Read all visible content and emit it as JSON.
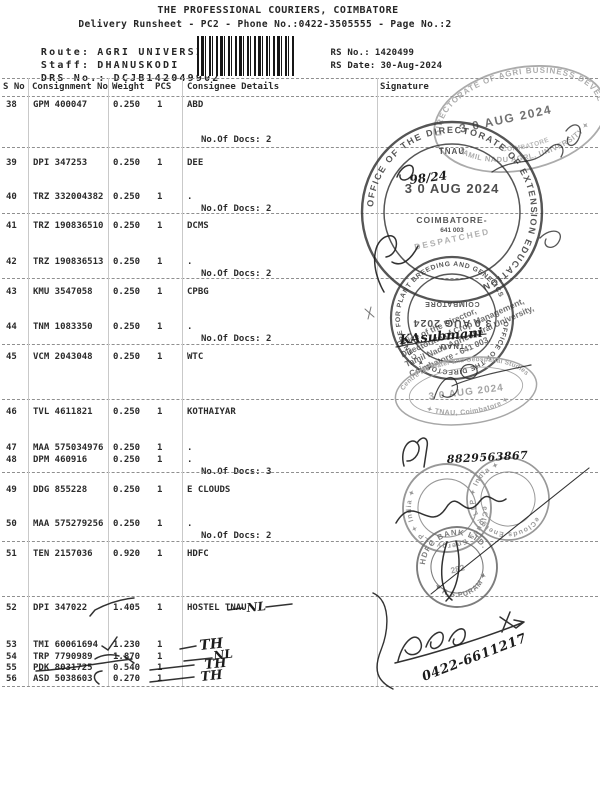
{
  "header": {
    "title": "THE PROFESSIONAL COURIERS, COIMBATORE",
    "subtitle": "Delivery Runsheet - PC2 - Phone No.:0422-3505555 - Page No.:2",
    "route_label": "Route:",
    "route_value": "AGRI UNIVERSITY -1",
    "staff_label": "Staff:",
    "staff_value": "DHANUSKODI",
    "drs_label": "DRS No.:",
    "drs_value": "DCJB142049902",
    "rs_no_label": "RS No.:",
    "rs_no_value": "1420499",
    "rs_date_label": "RS Date:",
    "rs_date_value": "30-Aug-2024"
  },
  "table": {
    "headers": {
      "sno": "S No",
      "cn": "Consignment No",
      "wt": "Weight",
      "pcs": "PCS",
      "consignee": "Consignee Details",
      "signature": "Signature"
    },
    "rows": [
      {
        "sno": "38",
        "cn": "GPM 400047",
        "wt": "0.250",
        "pcs": "1",
        "consignee": "ABD",
        "docs": "No.Of Docs: 2"
      },
      {
        "sno": "39",
        "cn": "DPI 347253",
        "wt": "0.250",
        "pcs": "1",
        "consignee": "DEE",
        "docs": ""
      },
      {
        "sno": "40",
        "cn": "TRZ 332004382",
        "wt": "0.250",
        "pcs": "1",
        "consignee": ".",
        "docs": "No.Of Docs: 2"
      },
      {
        "sno": "41",
        "cn": "TRZ 190836510",
        "wt": "0.250",
        "pcs": "1",
        "consignee": "DCMS",
        "docs": ""
      },
      {
        "sno": "42",
        "cn": "TRZ 190836513",
        "wt": "0.250",
        "pcs": "1",
        "consignee": ".",
        "docs": "No.Of Docs: 2"
      },
      {
        "sno": "43",
        "cn": "KMU 3547058",
        "wt": "0.250",
        "pcs": "1",
        "consignee": "CPBG",
        "docs": ""
      },
      {
        "sno": "44",
        "cn": "TNM 1083350",
        "wt": "0.250",
        "pcs": "1",
        "consignee": ".",
        "docs": "No.Of Docs: 2"
      },
      {
        "sno": "45",
        "cn": "VCM 2043048",
        "wt": "0.250",
        "pcs": "1",
        "consignee": "WTC",
        "docs": ""
      },
      {
        "sno": "46",
        "cn": "TVL 4611821",
        "wt": "0.250",
        "pcs": "1",
        "consignee": "KOTHAIYAR",
        "docs": ""
      },
      {
        "sno": "47",
        "cn": "MAA 575034976",
        "wt": "0.250",
        "pcs": "1",
        "consignee": ".",
        "docs": ""
      },
      {
        "sno": "48",
        "cn": "DPM 460916",
        "wt": "0.250",
        "pcs": "1",
        "consignee": ".",
        "docs": "No.Of Docs: 3"
      },
      {
        "sno": "49",
        "cn": "DDG 855228",
        "wt": "0.250",
        "pcs": "1",
        "consignee": "E CLOUDS",
        "docs": ""
      },
      {
        "sno": "50",
        "cn": "MAA 575279256",
        "wt": "0.250",
        "pcs": "1",
        "consignee": ".",
        "docs": "No.Of Docs: 2"
      },
      {
        "sno": "51",
        "cn": "TEN 2157036",
        "wt": "0.920",
        "pcs": "1",
        "consignee": "HDFC",
        "docs": ""
      },
      {
        "sno": "52",
        "cn": "DPI 347022",
        "wt": "1.405",
        "pcs": "1",
        "consignee": "HOSTEL TNAU",
        "docs": ""
      },
      {
        "sno": "53",
        "cn": "TMI 60061694",
        "wt": "1.230",
        "pcs": "1",
        "consignee": "",
        "docs": ""
      },
      {
        "sno": "54",
        "cn": "TRP 7790989",
        "wt": "1.870",
        "pcs": "1",
        "consignee": "",
        "docs": ""
      },
      {
        "sno": "55",
        "cn": "PDK 8031725",
        "wt": "0.540",
        "pcs": "1",
        "consignee": "",
        "docs": ""
      },
      {
        "sno": "56",
        "cn": "ASD 5038603",
        "wt": "0.270",
        "pcs": "1",
        "consignee": "",
        "docs": ""
      }
    ]
  },
  "stamps": {
    "agri": {
      "arc_top": "DIRECTORATE OF AGRI BUSINESS DEVEL",
      "arc_bottom": "TAMIL NADU AGRL. UNIVERSITY ✦",
      "arc_inner": "COIMBATORE",
      "date": "3 0 AUG 2024"
    },
    "extension": {
      "ring": "OFFICE OF THE DIRECTORATE OF EXTENSION EDUCATION",
      "tnau": "TNAU",
      "date": "3 0 AUG 2024",
      "city": "COIMBATORE-",
      "pin": "641 003",
      "despatched": "DESPATCHED"
    },
    "crop_office": {
      "lines": [
        "Office of the Director,",
        "Directorate of Crop Management,",
        "Tamil Nadu Agricultural University,",
        "Coimbatore - 641 003."
      ]
    },
    "director": {
      "ring": "OFFICE OF THE DIRECTOR ✦ CENTRE FOR PLANT BREEDING AND GENETICS",
      "tnau": "TNAU",
      "date": "3 0 AUG 2024",
      "city": "COIMBATORE"
    },
    "studies": {
      "arc_top": "Centre for Water and Geospatial Studies",
      "date": "3 0 AUG 2024",
      "arc_bottom": "✦ TNAU, Coimbatore ✦"
    },
    "eclouds": {
      "ring": "eClouds Energy LLP ✦ India ✦"
    },
    "hdfc": {
      "arc_top": "HDFC BANK LTD.",
      "arc_bottom": "✦ R.S.PURAM ✦",
      "code": "282"
    }
  },
  "handwriting": {
    "row52_mark": "NL",
    "row53_mark": "TH",
    "row54_mark": "NL",
    "row55_mark": "TH",
    "row56_mark": "TH",
    "extension_note": "98/24",
    "director_sign": "KAsubmani",
    "mobile": "8829563867",
    "phone": "0422-6611217"
  },
  "colors": {
    "paper": "#ffffff",
    "print_ink": "#262626",
    "stamp_ink_dark": "#383838",
    "stamp_ink_light": "#979797",
    "pen_ink": "#1c1c1c"
  }
}
